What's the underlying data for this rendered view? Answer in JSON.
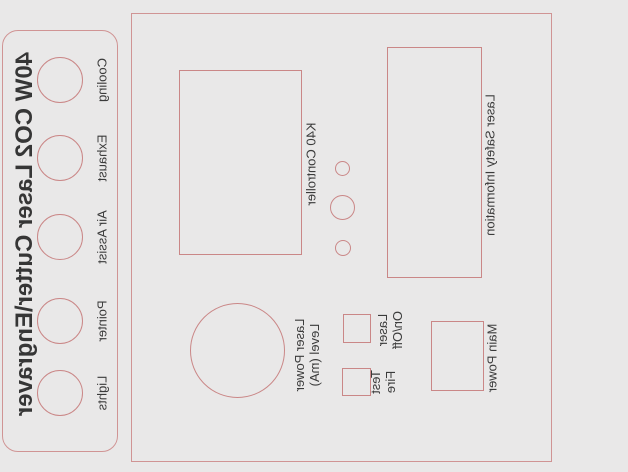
{
  "design": {
    "title": "40W CO2 Laser Cutter\\Engraver",
    "connector_panel": {
      "holes": [
        {
          "label": "Cooling"
        },
        {
          "label": "Exhaust"
        },
        {
          "label": "Air Assist"
        },
        {
          "label": "Pointer"
        },
        {
          "label": "Lights"
        }
      ]
    },
    "control_panel": {
      "k40_label": "K40 Controller",
      "safety_label": "Laser Safety Information",
      "power_label": "Laser Power\nLevel (mA)",
      "onoff_label": "Laser\nOn/Off",
      "testfire_label": "Test\nFire",
      "main_power_label": "Main Power"
    },
    "colors": {
      "outline": "#ca8787",
      "background": "#e9e8e8",
      "text": "#3b3b3b"
    }
  }
}
